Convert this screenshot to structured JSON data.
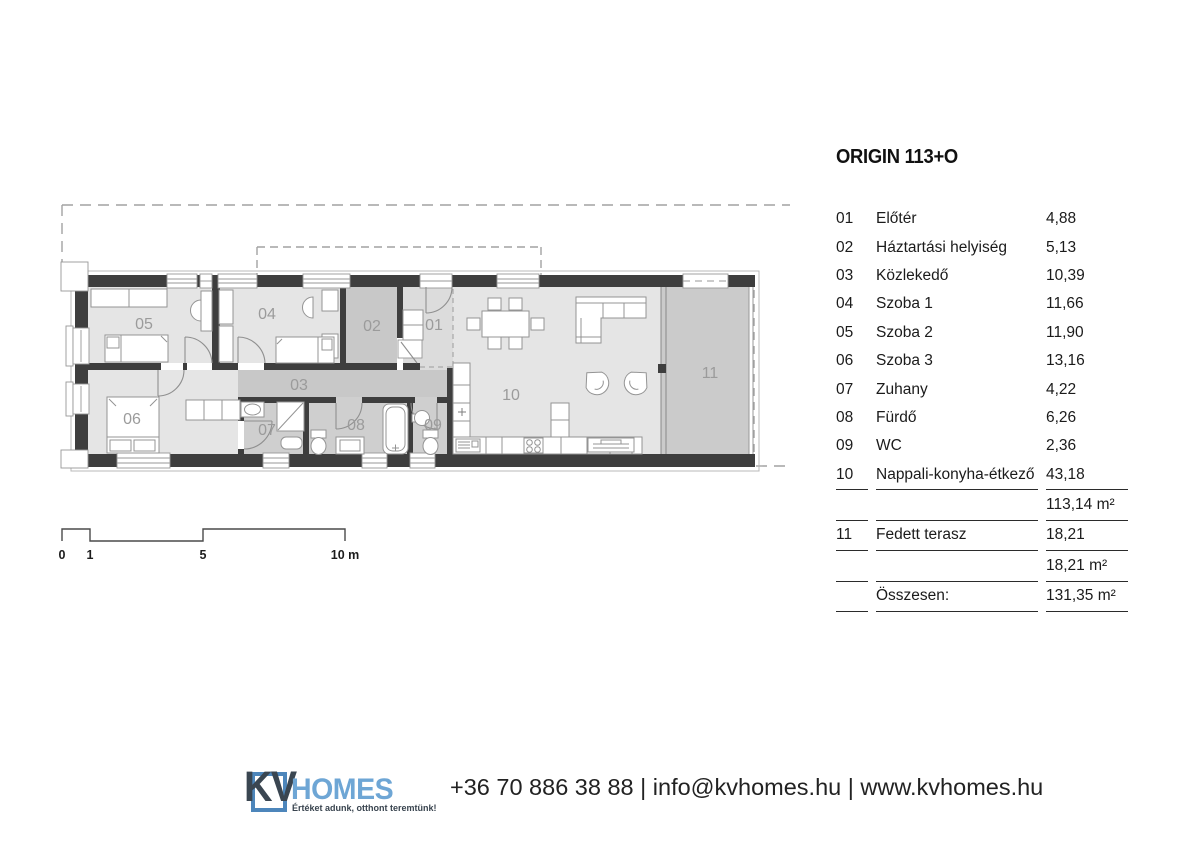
{
  "legend": {
    "title": "ORIGIN 113+O",
    "rows": [
      {
        "num": "01",
        "name": "Előtér",
        "area": "4,88"
      },
      {
        "num": "02",
        "name": "Háztartási helyiség",
        "area": "5,13"
      },
      {
        "num": "03",
        "name": "Közlekedő",
        "area": "10,39"
      },
      {
        "num": "04",
        "name": "Szoba 1",
        "area": "11,66"
      },
      {
        "num": "05",
        "name": "Szoba 2",
        "area": "11,90"
      },
      {
        "num": "06",
        "name": "Szoba 3",
        "area": "13,16"
      },
      {
        "num": "07",
        "name": "Zuhany",
        "area": "4,22"
      },
      {
        "num": "08",
        "name": "Fürdő",
        "area": "6,26"
      },
      {
        "num": "09",
        "name": "WC",
        "area": "2,36"
      },
      {
        "num": "10",
        "name": "Nappali-konyha-étkező",
        "area": "43,18"
      }
    ],
    "main_subtotal": "113,14 m²",
    "terrace_row": {
      "num": "11",
      "name": "Fedett terasz",
      "area": "18,21"
    },
    "terrace_subtotal": "18,21 m²",
    "total_label": "Összesen:",
    "total_value": "131,35 m²"
  },
  "plan": {
    "room_labels": {
      "r01": "01",
      "r02": "02",
      "r03": "03",
      "r04": "04",
      "r05": "05",
      "r06": "06",
      "r07": "07",
      "r08": "08",
      "r09": "09",
      "r10": "10",
      "r11": "11"
    },
    "scale_labels": {
      "zero": "0",
      "one": "1",
      "five": "5",
      "ten": "10 m"
    }
  },
  "footer": {
    "logo_kv": "KV",
    "logo_homes": "HOMES",
    "logo_tagline": "Értéket adunk, otthont teremtünk!",
    "phone": "+36 70 886 38 88",
    "email": "info@kvhomes.hu",
    "website": "www.kvhomes.hu",
    "separator": "|"
  },
  "colors": {
    "wall": "#3e3e3e",
    "room_light": "#e5e5e5",
    "room_mid": "#dcdcdc",
    "room_dark": "#c8c8c8",
    "terrace": "#cbcbcb",
    "logo_blue": "#6ea6d5",
    "logo_dark": "#3a4651"
  }
}
